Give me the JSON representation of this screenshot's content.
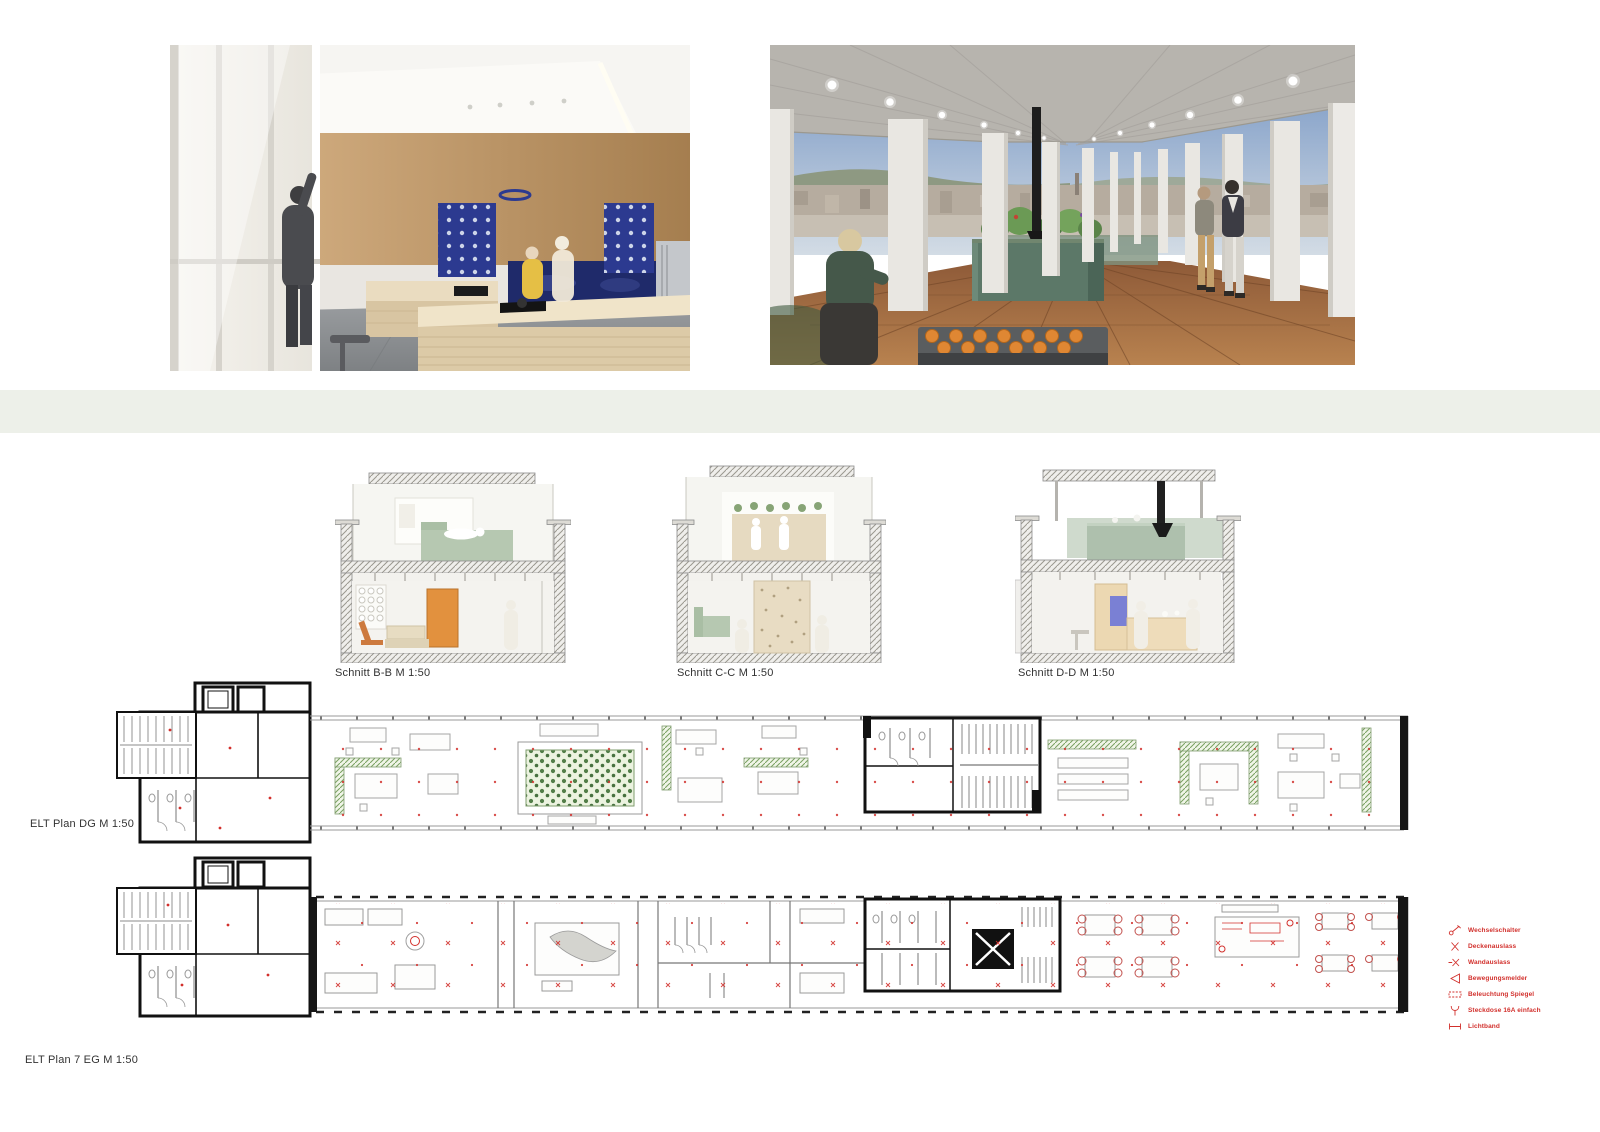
{
  "colors": {
    "background": "#ffffff",
    "band": "#edf0e9",
    "legend_red": "#d2302c",
    "planter_green": "#4f7d49",
    "section_sage": "#b6c8b1",
    "accent_orange": "#e2913e",
    "accent_blue": "#2c3a90"
  },
  "renders": {
    "interior": {
      "alt": "interior-kitchen-rendering"
    },
    "rooftop": {
      "alt": "rooftop-terrace-rendering"
    }
  },
  "sections": [
    {
      "label": "Schnitt B-B M 1:50"
    },
    {
      "label": "Schnitt C-C M 1:50"
    },
    {
      "label": "Schnitt D-D M 1:50"
    }
  ],
  "plans": [
    {
      "label": "ELT Plan DG M 1:50"
    },
    {
      "label": "ELT Plan 7 EG M 1:50"
    }
  ],
  "legend": {
    "items": [
      {
        "icon": "two-way-switch-icon",
        "label": "Wechselschalter"
      },
      {
        "icon": "ceiling-outlet-icon",
        "label": "Deckenauslass"
      },
      {
        "icon": "wall-outlet-icon",
        "label": "Wandauslass"
      },
      {
        "icon": "motion-detector-icon",
        "label": "Bewegungsmelder"
      },
      {
        "icon": "mirror-light-icon",
        "label": "Beleuchtung Spiegel"
      },
      {
        "icon": "socket-icon",
        "label": "Steckdose 16A einfach"
      },
      {
        "icon": "light-strip-icon",
        "label": "Lichtband"
      }
    ]
  }
}
